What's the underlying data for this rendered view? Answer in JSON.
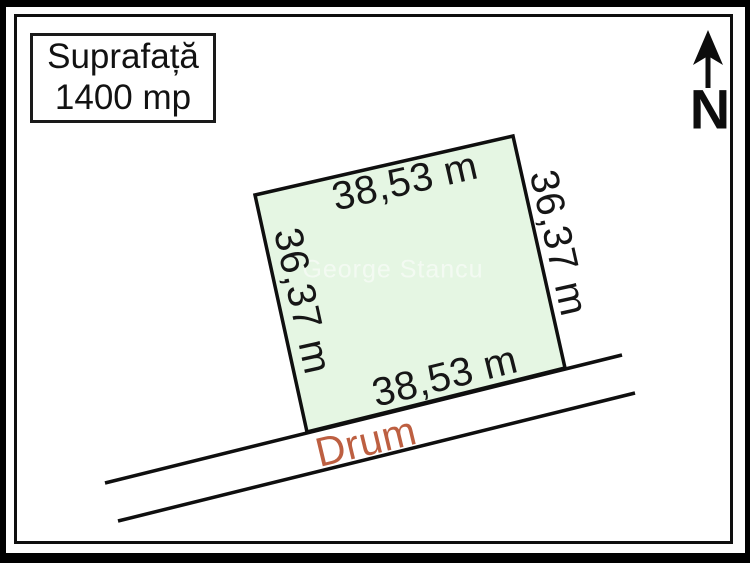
{
  "area_box": {
    "label": "Suprafață",
    "value": "1400 mp"
  },
  "compass": {
    "label": "N"
  },
  "parcel": {
    "fill_color": "#e5f6e3",
    "stroke_color": "#0f0f0f",
    "dim_top": "38,53 m",
    "dim_bottom": "38,53 m",
    "dim_left": "36,37 m",
    "dim_right": "36,37 m"
  },
  "road": {
    "label": "Drum",
    "label_color": "#bd5f41"
  },
  "watermark": {
    "text": "George Stancu"
  }
}
